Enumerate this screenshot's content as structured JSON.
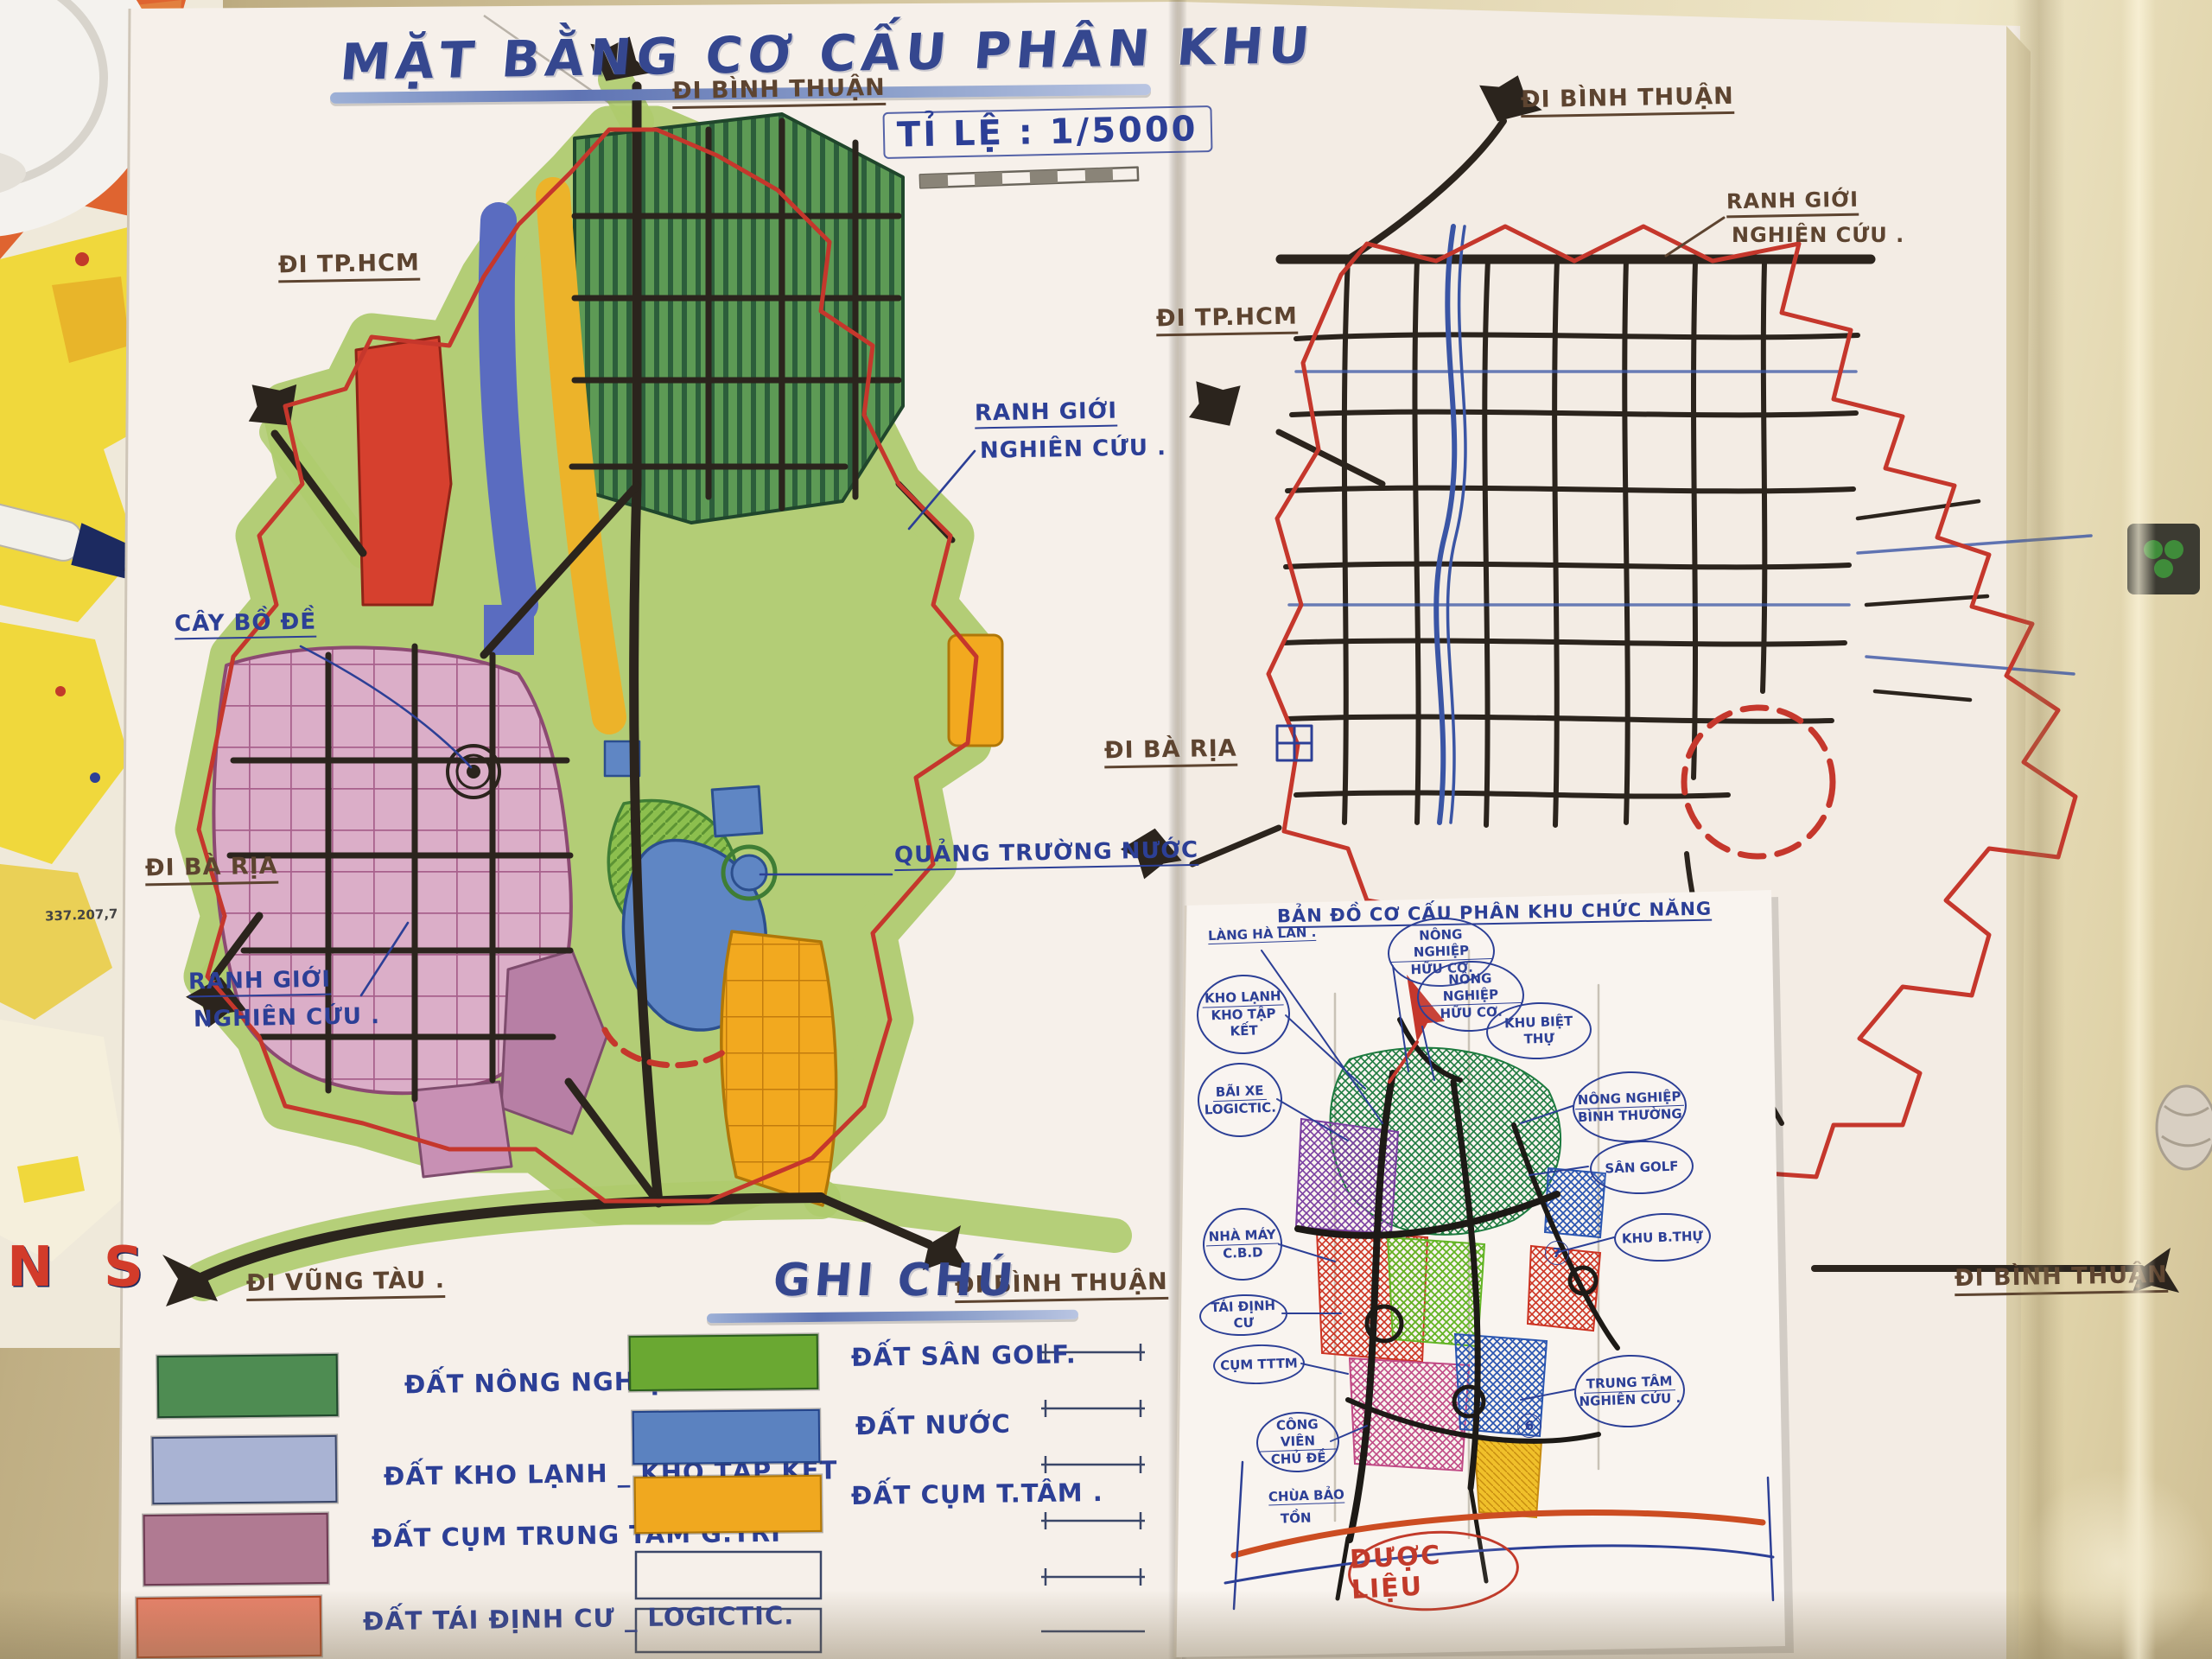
{
  "palette": {
    "paper": "#f6f0ea",
    "ink_blue": "#2c3f96",
    "ink_brown": "#5d4430",
    "ink_black": "#2b241d",
    "boundary_red": "#c5372c",
    "halo_green": "#a9cb68",
    "agri_green": "#4e8c52",
    "golf_green": "#8cbf4e",
    "water_blue": "#5f86c4",
    "zone_red": "#d6402e",
    "zone_blue": "#5a6cc0",
    "zone_yellow": "#ecb32a",
    "zone_pink": "#dbaec8",
    "zone_mauve": "#b77fa5",
    "zone_orange": "#f0a81f",
    "zone_salmon": "#e8826a",
    "zone_lightblue": "#a9b3d3"
  },
  "left_map": {
    "title": "MẶT BẰNG CƠ CẤU PHÂN KHU",
    "scale_label": "TỈ LỆ : 1/5000",
    "roads": {
      "top": "ĐI BÌNH THUẬN",
      "left_upper": "ĐI TP.HCM",
      "left_lower": "ĐI BÀ RỊA",
      "bottom_left": "ĐI VŨNG TÀU .",
      "bottom_right": "ĐI BÌNH THUẬN"
    },
    "annotations": {
      "boundary_right_l1": "RANH GIỚI",
      "boundary_right_l2": "NGHIÊN CỨU .",
      "bodhi_tree": "CÂY BỒ ĐỀ",
      "water_square": "QUẢNG TRƯỜNG NƯỚC",
      "boundary_left_l1": "RANH GIỚI",
      "boundary_left_l2": "NGHIÊN CỨU ."
    }
  },
  "right_map": {
    "roads": {
      "top": "ĐI BÌNH THUẬN",
      "left_upper": "ĐI TP.HCM",
      "left_lower": "ĐI BÀ RỊA",
      "bottom_right": "ĐI BÌNH THUẬN"
    },
    "annotations": {
      "boundary_l1": "RANH GIỚI",
      "boundary_l2": "NGHIÊN CỨU ."
    }
  },
  "legend": {
    "title": "GHI CHÚ",
    "column1": [
      {
        "label": "ĐẤT NÔNG NGHIỆP HỮU CƠ.",
        "color": "#4e8c52"
      },
      {
        "label": "ĐẤT KHO LẠNH _ KHO TẬP KẾT",
        "color": "#a9b3d3"
      },
      {
        "label": "ĐẤT CỤM TRUNG TÂM G.TRÍ",
        "color": "#b07a92"
      },
      {
        "label": "ĐẤT TÁI ĐỊNH CƯ _ LOGICTIC.",
        "color": "#e8826a"
      }
    ],
    "column2": [
      {
        "label": "ĐẤT SÂN GOLF.",
        "color": "#6aa832"
      },
      {
        "label": "ĐẤT NƯỚC",
        "color": "#5b82c0"
      },
      {
        "label": "ĐẤT CỤM T.TÂM .",
        "color": "#f0a81f"
      }
    ]
  },
  "inset": {
    "title": "BẢN ĐỒ CƠ CẤU PHÂN KHU CHỨC NĂNG",
    "labels": {
      "lang_ha_lan": "LÀNG HÀ LAN .",
      "kho_lanh_l1": "KHO LẠNH",
      "kho_lanh_l2": "KHO TẬP KẾT",
      "bai_xe_l1": "BÃI XE",
      "bai_xe_l2": "LOGICTIC.",
      "nha_may_l1": "NHÀ MÁY",
      "nha_may_l2": "C.B.D",
      "tai_dinh_cu": "TÁI ĐỊNH CƯ",
      "cum_tttm": "CỤM TTTM",
      "cong_vien_l1": "CÔNG VIÊN",
      "cong_vien_l2": "CHỦ ĐỀ",
      "chua_l1": "CHÙA BẢO",
      "chua_l2": "TỒN",
      "nong_nghiep1_l1": "NÔNG NGHIỆP",
      "nong_nghiep1_l2": "HỮU CƠ.",
      "nong_nghiep2_l1": "NÔNG NGHIỆP",
      "nong_nghiep2_l2": "HỮU CƠ.",
      "khu_biet_thu": "KHU BIỆT THỰ",
      "nn_binh_thuong_l1": "NÔNG NGHIỆP",
      "nn_binh_thuong_l2": "BÌNH THƯỜNG",
      "san_golf": "SÂN GOLF",
      "khu_b_thu": "KHU B.THỰ",
      "trung_tam_l1": "TRUNG TÂM",
      "trung_tam_l2": "NGHIÊN CỨU .",
      "duoc_lieu": "DƯỢC LIỆU",
      "badge_a": "7",
      "badge_b": "6"
    }
  },
  "background": {
    "fragment_number": "337.207,7",
    "fragment_letters": "N S"
  }
}
